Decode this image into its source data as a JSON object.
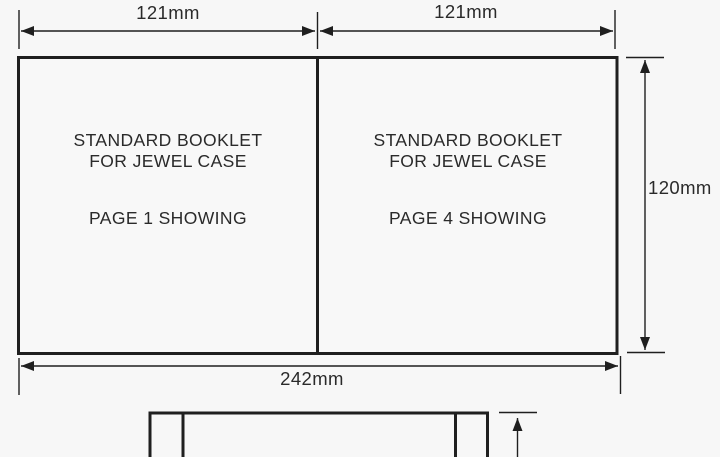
{
  "diagram": {
    "dimensions": {
      "top_left_width": "121mm",
      "top_right_width": "121mm",
      "right_height": "120mm",
      "bottom_total_width": "242mm"
    },
    "panel_left": {
      "title_line1": "STANDARD BOOKLET",
      "title_line2": "FOR JEWEL CASE",
      "page_line": "PAGE 1 SHOWING"
    },
    "panel_right": {
      "title_line1": "STANDARD BOOKLET",
      "title_line2": "FOR JEWEL CASE",
      "page_line": "PAGE 4 SHOWING"
    },
    "colors": {
      "line": "#1f1f1f",
      "text": "#2a2a2a",
      "background": "#f7f7f7",
      "panel_fill": "#f8f8f8"
    }
  }
}
